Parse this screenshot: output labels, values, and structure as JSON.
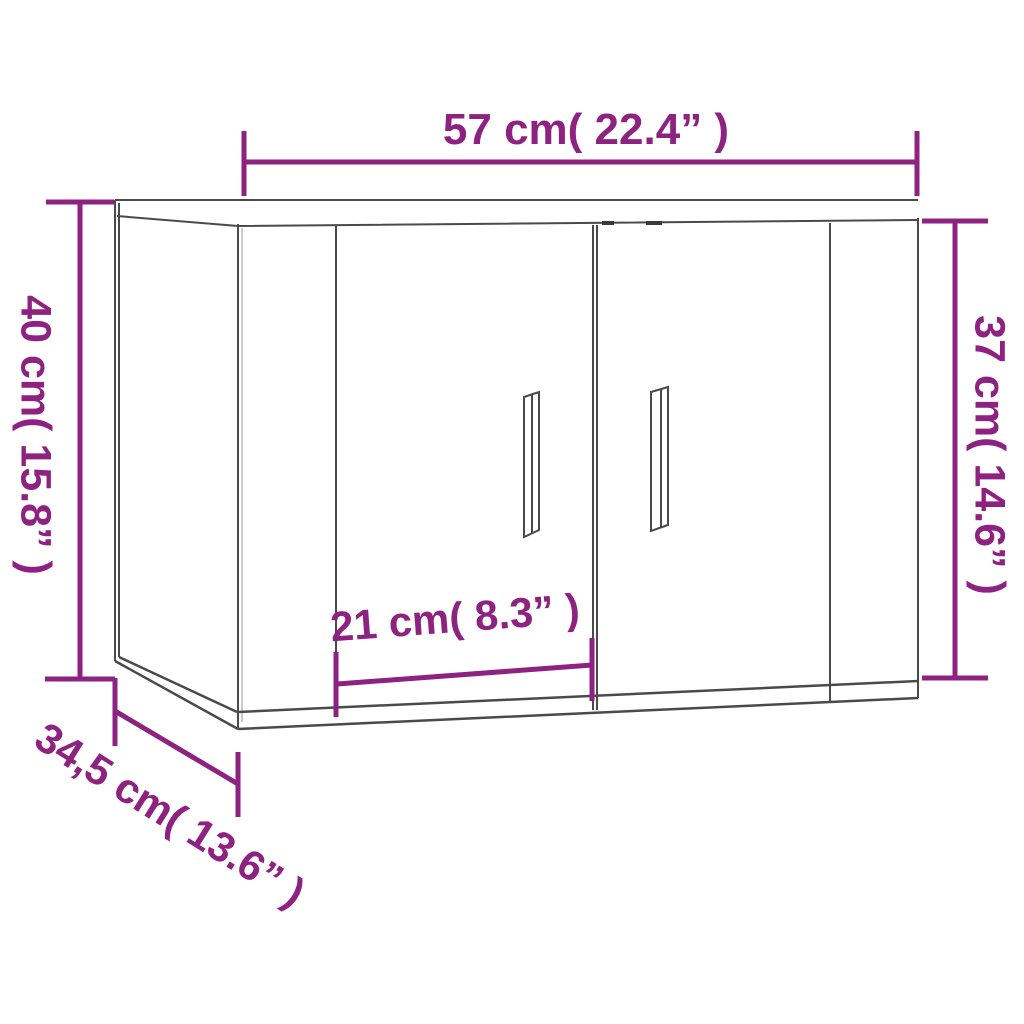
{
  "diagram": {
    "type": "product-dimension-diagram",
    "subject": "wall-mounted cabinet with two doors and vertical handles",
    "colors": {
      "dimension_accent": "#8E2280",
      "drawing_line": "#4a4a4a",
      "background": "#ffffff"
    },
    "dimensions": {
      "width": {
        "label": "57 cm( 22.4” )",
        "cm": "57",
        "inches": "22.4"
      },
      "height_left": {
        "label": "40 cm( 15.8” )",
        "cm": "40",
        "inches": "15.8"
      },
      "height_right": {
        "label": "37 cm( 14.6” )",
        "cm": "37",
        "inches": "14.6"
      },
      "door_width": {
        "label": "21 cm( 8.3” )",
        "cm": "21",
        "inches": "8.3"
      },
      "depth": {
        "label": "34,5 cm( 13.6” )",
        "cm": "34,5",
        "inches": "13.6"
      }
    }
  }
}
